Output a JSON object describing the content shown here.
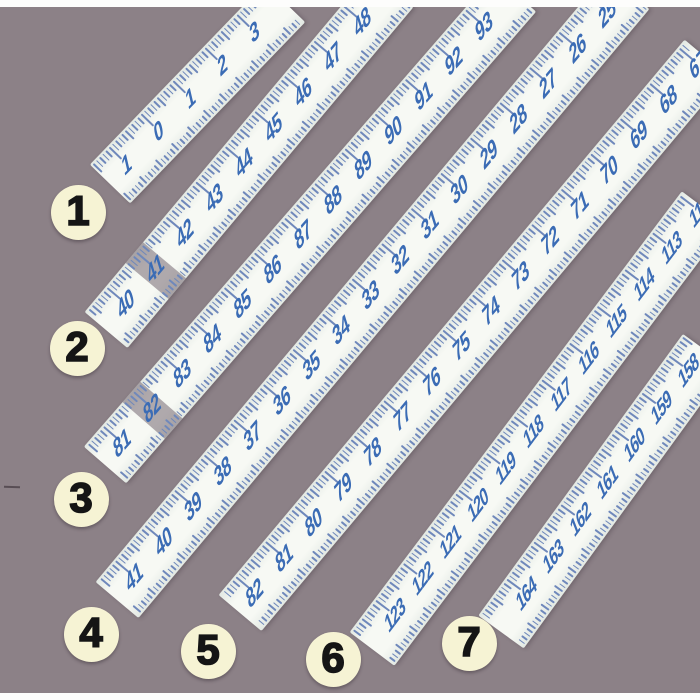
{
  "scene": {
    "description": "Photograph of seven tape measure segments laid diagonally on a mauve background, each marked with a numbered circle callout",
    "background_color": "#8c8187",
    "scan_border_color": "#fdfdfc"
  },
  "tape_style": {
    "body_edge_color": "#e2e8e3",
    "body_center_color": "#f7f9f4",
    "tick_color": "#6f88bb",
    "number_color": "#3b6cb5",
    "splice_band_color": "rgba(130,120,127,0.62)"
  },
  "callout_style": {
    "fill_color": "#f6f3d4",
    "text_color": "#151515"
  },
  "callouts": [
    {
      "label": "1"
    },
    {
      "label": "2"
    },
    {
      "label": "3"
    },
    {
      "label": "4"
    },
    {
      "label": "5"
    },
    {
      "label": "6"
    },
    {
      "label": "7"
    }
  ],
  "tapes": [
    {
      "name": "tape-segment-1",
      "numbers": [
        "1",
        "0",
        "1",
        "2",
        "3"
      ]
    },
    {
      "name": "tape-segment-2",
      "numbers": [
        "40",
        "41",
        "42",
        "43",
        "44",
        "45",
        "46",
        "47",
        "48"
      ],
      "splice_at_index": 1
    },
    {
      "name": "tape-segment-3",
      "numbers": [
        "81",
        "82",
        "83",
        "84",
        "85",
        "86",
        "87",
        "88",
        "89",
        "90",
        "91",
        "92",
        "93"
      ],
      "splice_at_index": 1
    },
    {
      "name": "tape-segment-4",
      "numbers": [
        "41",
        "40",
        "39",
        "38",
        "37",
        "36",
        "35",
        "34",
        "33",
        "32",
        "31",
        "30",
        "29",
        "28",
        "27",
        "26",
        "25"
      ]
    },
    {
      "name": "tape-segment-5",
      "numbers": [
        "82",
        "81",
        "80",
        "79",
        "78",
        "77",
        "76",
        "75",
        "74",
        "73",
        "72",
        "71",
        "70",
        "69",
        "68",
        "67"
      ]
    },
    {
      "name": "tape-segment-6",
      "numbers": [
        "123",
        "122",
        "121",
        "120",
        "119",
        "118",
        "117",
        "116",
        "115",
        "114",
        "113",
        "112"
      ]
    },
    {
      "name": "tape-segment-7",
      "numbers": [
        "164",
        "163",
        "162",
        "161",
        "160",
        "159",
        "158"
      ]
    }
  ]
}
